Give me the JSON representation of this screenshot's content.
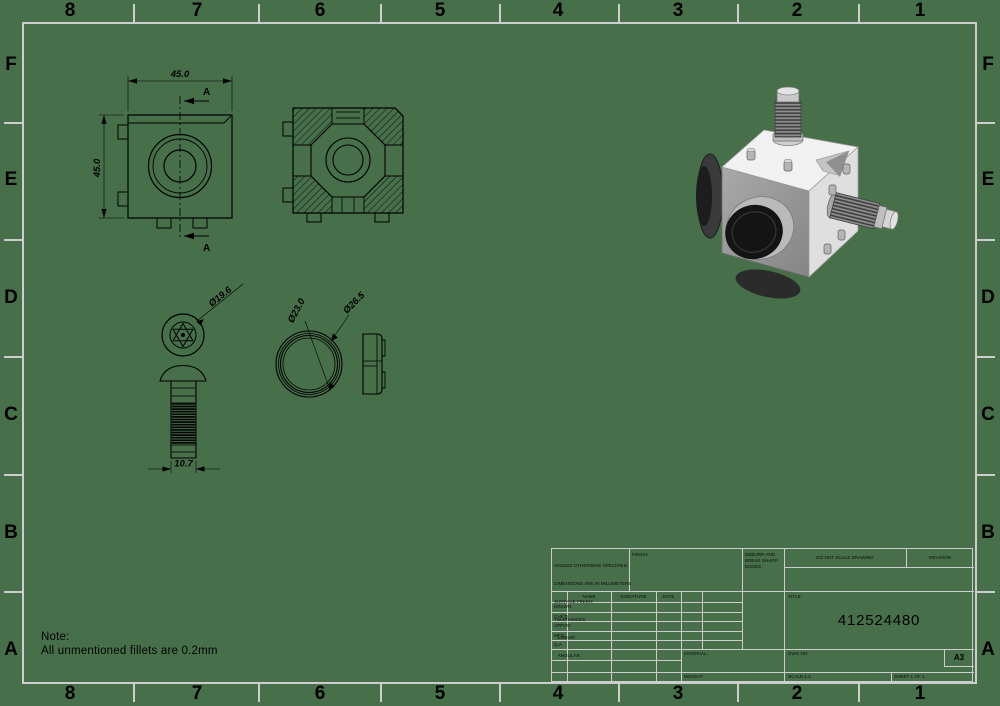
{
  "sheet": {
    "background_color": "#47704a",
    "frame_color": "#cdcdcd",
    "line_color": "#000000",
    "render_body_color": "#f1f1f1",
    "render_face_color": "#9a9a9a",
    "render_cap_color": "#141414"
  },
  "zones": {
    "columns": [
      "8",
      "7",
      "6",
      "5",
      "4",
      "3",
      "2",
      "1"
    ],
    "rows": [
      "F",
      "E",
      "D",
      "C",
      "B",
      "A"
    ]
  },
  "note": {
    "title": "Note:",
    "body": "All unmentioned fillets are 0.2mm"
  },
  "dimensions": {
    "front_width": "45.0",
    "front_height": "45.0",
    "section_label_top": "A",
    "section_label_bottom": "A",
    "head_diameter": "Ø19.6",
    "screw_length": "10.7",
    "ring_inner_diameter": "Ø23.0",
    "ring_outer_diameter": "Ø26.5"
  },
  "title_block": {
    "spec_lines": [
      "UNLESS OTHERWISE SPECIFIED:",
      "DIMENSIONS ARE IN MILLIMETERS",
      "SURFACE FINISH:",
      "TOLERANCES:",
      "   LINEAR:",
      "   ANGULAR:"
    ],
    "finish_label": "FINISH:",
    "deburr_note": "DEBURR AND BREAK SHARP EDGES",
    "do_not_scale": "DO NOT SCALE DRAWING",
    "revision_label": "REVISION",
    "title_label": "TITLE:",
    "drawing_number": "412524480",
    "table_headers": [
      "NAME",
      "SIGNATURE",
      "DATE"
    ],
    "table_rows": [
      "DRAWN",
      "CHK'D",
      "APPV'D",
      "MFG",
      "Q.A"
    ],
    "material_label": "MATERIAL:",
    "weight_label": "WEIGHT:",
    "dwg_no_label": "DWG NO.",
    "paper_size": "A3",
    "scale_label": "SCALE:1:2",
    "sheet_label": "SHEET 1 OF 1"
  }
}
